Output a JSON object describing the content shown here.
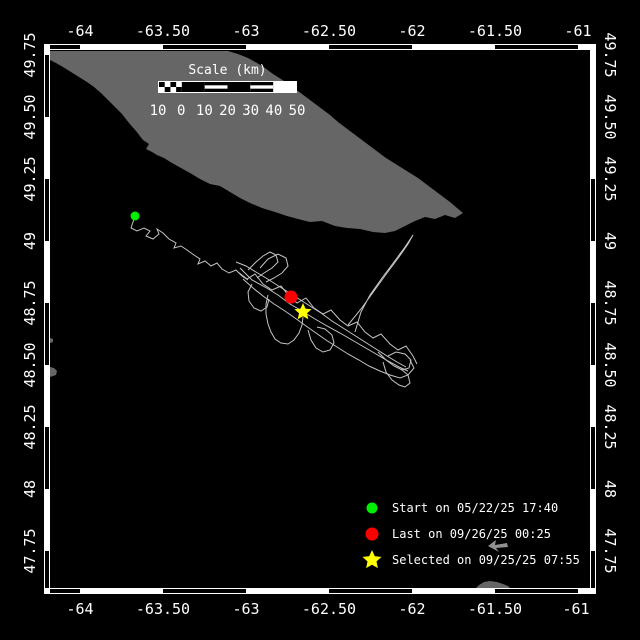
{
  "colors": {
    "background": "#000000",
    "frame": "#ffffff",
    "land": "#666666",
    "track": "#c4c4c4",
    "start": "#00ee00",
    "last": "#ff0000",
    "selected": "#ffff00",
    "cursor": "#909090"
  },
  "axes": {
    "top": [
      {
        "text": "-64",
        "x": 80
      },
      {
        "text": "-63.50",
        "x": 163
      },
      {
        "text": "-63",
        "x": 246
      },
      {
        "text": "-62.50",
        "x": 329
      },
      {
        "text": "-62",
        "x": 412
      },
      {
        "text": "-61.50",
        "x": 495
      },
      {
        "text": "-61",
        "x": 578
      }
    ],
    "bottom": [
      {
        "text": "-64",
        "x": 80
      },
      {
        "text": "-63.50",
        "x": 163
      },
      {
        "text": "-63",
        "x": 246
      },
      {
        "text": "-62.50",
        "x": 329
      },
      {
        "text": "-62",
        "x": 412
      },
      {
        "text": "-61.50",
        "x": 495
      },
      {
        "text": "-61",
        "x": 576
      }
    ],
    "left": [
      {
        "text": "49.75",
        "y": 55
      },
      {
        "text": "49.50",
        "y": 117
      },
      {
        "text": "49.25",
        "y": 179
      },
      {
        "text": "49",
        "y": 241
      },
      {
        "text": "48.75",
        "y": 303
      },
      {
        "text": "48.50",
        "y": 365
      },
      {
        "text": "48.25",
        "y": 427
      },
      {
        "text": "48",
        "y": 489
      },
      {
        "text": "47.75",
        "y": 551
      }
    ],
    "right": [
      {
        "text": "49.75",
        "y": 55
      },
      {
        "text": "49.50",
        "y": 117
      },
      {
        "text": "49.25",
        "y": 179
      },
      {
        "text": "49",
        "y": 241
      },
      {
        "text": "48.75",
        "y": 303
      },
      {
        "text": "48.50",
        "y": 365
      },
      {
        "text": "48.25",
        "y": 427
      },
      {
        "text": "48",
        "y": 489
      },
      {
        "text": "47.75",
        "y": 551
      }
    ]
  },
  "border": {
    "h_black": [
      [
        48,
        80
      ],
      [
        163,
        246
      ],
      [
        329,
        412
      ],
      [
        495,
        578
      ]
    ],
    "v_black_left": [
      [
        55,
        117
      ],
      [
        179,
        241
      ],
      [
        303,
        365
      ],
      [
        427,
        489
      ],
      [
        551,
        588
      ]
    ],
    "v_black_right": [
      [
        179,
        241
      ],
      [
        303,
        365
      ],
      [
        427,
        489
      ],
      [
        551,
        588
      ]
    ]
  },
  "scalebar": {
    "title": "Scale (km)",
    "labels": [
      "10",
      "0",
      "10",
      "20",
      "30",
      "40",
      "50"
    ],
    "segments": [
      "checker",
      "black",
      "stripe",
      "black",
      "stripe",
      "white"
    ]
  },
  "legend": {
    "items": [
      {
        "marker": "circle",
        "color": "#00ee00",
        "label": "Start on 05/22/25 17:40",
        "y": 496
      },
      {
        "marker": "circle",
        "color": "#ff0000",
        "label": "Last on 09/26/25 00:25",
        "y": 522
      },
      {
        "marker": "star",
        "color": "#ffff00",
        "label": "Selected on 09/25/25 07:55",
        "y": 548
      }
    ]
  },
  "markers": {
    "start": {
      "x": 135,
      "y": 216,
      "r": 4.5,
      "color": "#00ee00"
    },
    "last": {
      "x": 291,
      "y": 297,
      "r": 6.5,
      "color": "#ff0000"
    },
    "selected": {
      "x": 303,
      "y": 312,
      "r": 9,
      "color": "#ffff00"
    }
  },
  "land": {
    "island": [
      [
        50,
        51
      ],
      [
        228,
        51
      ],
      [
        238,
        54
      ],
      [
        248,
        58
      ],
      [
        257,
        63
      ],
      [
        265,
        68
      ],
      [
        273,
        74
      ],
      [
        281,
        79
      ],
      [
        290,
        85
      ],
      [
        298,
        91
      ],
      [
        306,
        97
      ],
      [
        314,
        103
      ],
      [
        322,
        109
      ],
      [
        330,
        115
      ],
      [
        338,
        122
      ],
      [
        346,
        128
      ],
      [
        354,
        134
      ],
      [
        362,
        140
      ],
      [
        370,
        146
      ],
      [
        378,
        152
      ],
      [
        386,
        158
      ],
      [
        394,
        163
      ],
      [
        402,
        168
      ],
      [
        410,
        173
      ],
      [
        418,
        178
      ],
      [
        426,
        184
      ],
      [
        434,
        190
      ],
      [
        442,
        196
      ],
      [
        450,
        202
      ],
      [
        457,
        208
      ],
      [
        463,
        213
      ],
      [
        455,
        218
      ],
      [
        445,
        215
      ],
      [
        435,
        219
      ],
      [
        425,
        217
      ],
      [
        415,
        221
      ],
      [
        405,
        226
      ],
      [
        395,
        231
      ],
      [
        385,
        233
      ],
      [
        373,
        232
      ],
      [
        360,
        229
      ],
      [
        347,
        228
      ],
      [
        335,
        226
      ],
      [
        322,
        221
      ],
      [
        310,
        222
      ],
      [
        298,
        219
      ],
      [
        287,
        216
      ],
      [
        275,
        212
      ],
      [
        262,
        208
      ],
      [
        250,
        203
      ],
      [
        240,
        198
      ],
      [
        230,
        192
      ],
      [
        220,
        186
      ],
      [
        210,
        184
      ],
      [
        200,
        179
      ],
      [
        190,
        173
      ],
      [
        181,
        168
      ],
      [
        172,
        163
      ],
      [
        164,
        158
      ],
      [
        157,
        155
      ],
      [
        152,
        152
      ],
      [
        146,
        149
      ],
      [
        149,
        144
      ],
      [
        143,
        140
      ],
      [
        136,
        131
      ],
      [
        129,
        123
      ],
      [
        122,
        114
      ],
      [
        115,
        107
      ],
      [
        108,
        100
      ],
      [
        101,
        93
      ],
      [
        94,
        87
      ],
      [
        87,
        82
      ],
      [
        79,
        77
      ],
      [
        71,
        72
      ],
      [
        63,
        67
      ],
      [
        56,
        63
      ],
      [
        50,
        60
      ]
    ],
    "fragments": [
      [
        [
          50,
          338
        ],
        [
          53,
          339
        ],
        [
          53,
          342
        ],
        [
          50,
          343
        ]
      ],
      [
        [
          50,
          367
        ],
        [
          54,
          368
        ],
        [
          57,
          371
        ],
        [
          56,
          375
        ],
        [
          50,
          377
        ]
      ],
      [
        [
          476,
          588
        ],
        [
          479,
          585
        ],
        [
          484,
          582
        ],
        [
          490,
          581
        ],
        [
          497,
          582
        ],
        [
          503,
          584
        ],
        [
          508,
          586
        ],
        [
          510,
          588
        ]
      ]
    ]
  },
  "track": {
    "segments": [
      [
        [
          135,
          216
        ],
        [
          133,
          222
        ],
        [
          131,
          228
        ],
        [
          137,
          231
        ],
        [
          144,
          228
        ],
        [
          150,
          231
        ],
        [
          146,
          236
        ],
        [
          153,
          239
        ],
        [
          159,
          234
        ],
        [
          157,
          229
        ],
        [
          163,
          233
        ],
        [
          169,
          239
        ],
        [
          176,
          243
        ],
        [
          174,
          248
        ],
        [
          181,
          246
        ],
        [
          187,
          250
        ],
        [
          194,
          255
        ],
        [
          200,
          259
        ],
        [
          198,
          264
        ],
        [
          205,
          261
        ],
        [
          211,
          266
        ],
        [
          217,
          263
        ],
        [
          222,
          269
        ],
        [
          229,
          273
        ],
        [
          236,
          270
        ],
        [
          242,
          276
        ],
        [
          248,
          280
        ]
      ],
      [
        [
          236,
          262
        ],
        [
          246,
          266
        ],
        [
          256,
          272
        ],
        [
          266,
          278
        ],
        [
          277,
          285
        ],
        [
          288,
          292
        ],
        [
          299,
          299
        ],
        [
          310,
          306
        ],
        [
          321,
          313
        ],
        [
          332,
          321
        ],
        [
          343,
          328
        ],
        [
          354,
          335
        ],
        [
          365,
          342
        ],
        [
          376,
          349
        ],
        [
          387,
          356
        ],
        [
          397,
          362
        ],
        [
          406,
          367
        ]
      ],
      [
        [
          238,
          272
        ],
        [
          247,
          279
        ],
        [
          255,
          274
        ],
        [
          263,
          284
        ],
        [
          272,
          290
        ],
        [
          281,
          286
        ],
        [
          289,
          296
        ],
        [
          297,
          303
        ],
        [
          306,
          298
        ],
        [
          314,
          308
        ],
        [
          323,
          314
        ],
        [
          331,
          310
        ],
        [
          340,
          320
        ],
        [
          348,
          326
        ],
        [
          357,
          322
        ],
        [
          365,
          332
        ],
        [
          373,
          338
        ],
        [
          381,
          334
        ],
        [
          390,
          344
        ],
        [
          398,
          350
        ],
        [
          406,
          346
        ],
        [
          413,
          356
        ],
        [
          417,
          364
        ]
      ],
      [
        [
          243,
          279
        ],
        [
          253,
          288
        ],
        [
          263,
          296
        ],
        [
          274,
          304
        ],
        [
          285,
          311
        ],
        [
          295,
          318
        ],
        [
          306,
          326
        ],
        [
          316,
          333
        ],
        [
          326,
          340
        ],
        [
          337,
          347
        ],
        [
          348,
          354
        ],
        [
          359,
          360
        ],
        [
          369,
          366
        ],
        [
          380,
          371
        ],
        [
          390,
          375
        ],
        [
          400,
          378
        ],
        [
          408,
          375
        ],
        [
          414,
          368
        ],
        [
          410,
          360
        ]
      ],
      [
        [
          240,
          268
        ],
        [
          252,
          280
        ],
        [
          265,
          287
        ],
        [
          278,
          295
        ],
        [
          290,
          304
        ],
        [
          302,
          311
        ],
        [
          315,
          319
        ],
        [
          327,
          326
        ],
        [
          340,
          333
        ],
        [
          352,
          340
        ],
        [
          364,
          347
        ],
        [
          376,
          354
        ],
        [
          388,
          361
        ],
        [
          399,
          367
        ],
        [
          408,
          371
        ]
      ],
      [
        [
          248,
          270
        ],
        [
          256,
          262
        ],
        [
          263,
          256
        ],
        [
          270,
          252
        ],
        [
          276,
          255
        ],
        [
          278,
          262
        ],
        [
          272,
          268
        ],
        [
          264,
          273
        ],
        [
          257,
          278
        ]
      ],
      [
        [
          260,
          268
        ],
        [
          268,
          259
        ],
        [
          278,
          254
        ],
        [
          286,
          258
        ],
        [
          288,
          266
        ],
        [
          282,
          273
        ],
        [
          274,
          278
        ],
        [
          266,
          282
        ]
      ],
      [
        [
          308,
          330
        ],
        [
          311,
          340
        ],
        [
          316,
          348
        ],
        [
          323,
          352
        ],
        [
          330,
          350
        ],
        [
          334,
          343
        ],
        [
          332,
          335
        ],
        [
          325,
          329
        ],
        [
          317,
          327
        ]
      ],
      [
        [
          268,
          295
        ],
        [
          266,
          304
        ],
        [
          266,
          314
        ],
        [
          268,
          324
        ],
        [
          271,
          332
        ],
        [
          275,
          339
        ],
        [
          281,
          343
        ],
        [
          288,
          344
        ],
        [
          294,
          340
        ],
        [
          299,
          333
        ],
        [
          302,
          325
        ],
        [
          303,
          317
        ]
      ],
      [
        [
          252,
          284
        ],
        [
          248,
          292
        ],
        [
          249,
          301
        ],
        [
          254,
          308
        ],
        [
          261,
          311
        ],
        [
          267,
          307
        ],
        [
          269,
          299
        ]
      ],
      [
        [
          378,
          352
        ],
        [
          386,
          360
        ],
        [
          394,
          366
        ],
        [
          402,
          370
        ],
        [
          409,
          368
        ],
        [
          411,
          360
        ],
        [
          405,
          354
        ],
        [
          396,
          352
        ],
        [
          388,
          356
        ]
      ],
      [
        [
          383,
          362
        ],
        [
          386,
          372
        ],
        [
          392,
          380
        ],
        [
          399,
          385
        ],
        [
          405,
          387
        ],
        [
          410,
          383
        ],
        [
          408,
          375
        ],
        [
          401,
          369
        ]
      ],
      [
        [
          348,
          325
        ],
        [
          361,
          309
        ],
        [
          374,
          291
        ],
        [
          387,
          273
        ],
        [
          399,
          257
        ],
        [
          408,
          244
        ],
        [
          413,
          235
        ],
        [
          405,
          247
        ],
        [
          394,
          262
        ],
        [
          382,
          278
        ],
        [
          370,
          295
        ],
        [
          361,
          312
        ],
        [
          355,
          332
        ]
      ]
    ]
  }
}
